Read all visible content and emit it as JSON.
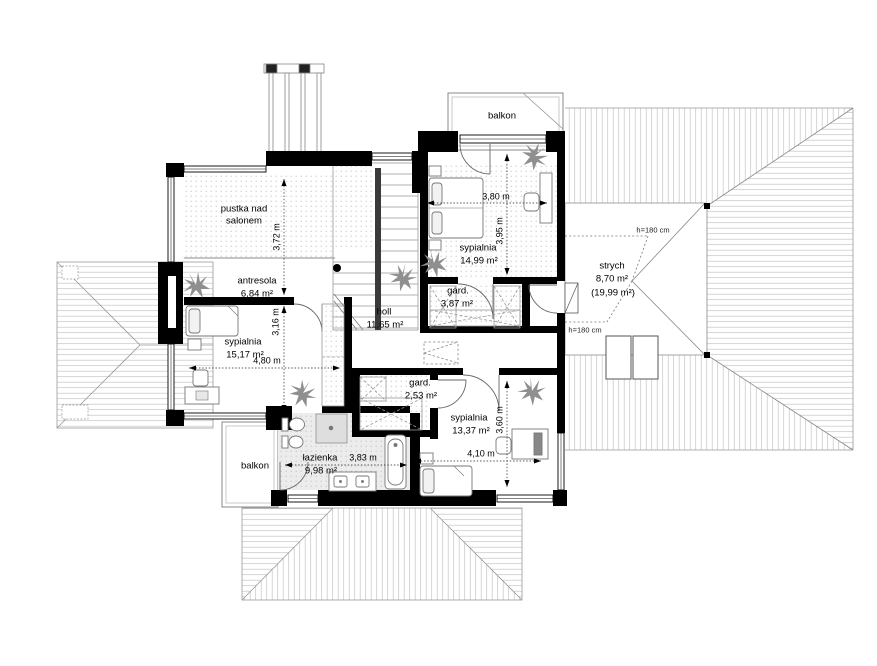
{
  "rooms": {
    "balkon_top": {
      "name": "balkon"
    },
    "pustka": {
      "name_line1": "pustka nad",
      "name_line2": "salonem"
    },
    "antresola": {
      "name": "antresola",
      "area": "6,84 m²"
    },
    "sypialnia_top": {
      "name": "sypialnia",
      "area": "14,99 m²"
    },
    "strych": {
      "name": "strych",
      "area": "8,70 m²",
      "area_total": "(19,99 m²)"
    },
    "holl": {
      "name": "holl",
      "area": "11,65 m²"
    },
    "gard_top": {
      "name": "gard.",
      "area": "3,87 m²"
    },
    "sypialnia_left": {
      "name": "sypialnia",
      "area": "15,17 m²"
    },
    "gard_bottom": {
      "name": "gard.",
      "area": "2,53 m²"
    },
    "sypialnia_bottom": {
      "name": "sypialnia",
      "area": "13,37 m²"
    },
    "lazienka": {
      "name": "łazienka",
      "area": "9,98 m²"
    },
    "balkon_bottom": {
      "name": "balkon"
    }
  },
  "dimensions": {
    "pustka_height": "3,72 m",
    "sypialnia_left_height": "3,16 m",
    "sypialnia_left_width": "4,80 m",
    "sypialnia_top_width": "3,80 m",
    "sypialnia_top_height": "3,95 m",
    "sypialnia_bottom_width": "4,10 m",
    "sypialnia_bottom_height": "3,60 m",
    "lazienka_width": "3,83 m",
    "attic_height_top": "h=180 cm",
    "attic_height_bottom": "h=180 cm"
  },
  "colors": {
    "wall": "#000000",
    "roof_edge": "#999999",
    "roof_hatch": "#c4c4c4",
    "floor_dot": "#c6c6c6",
    "bath_floor": "#ececec",
    "plant": "#8f8f8f"
  }
}
